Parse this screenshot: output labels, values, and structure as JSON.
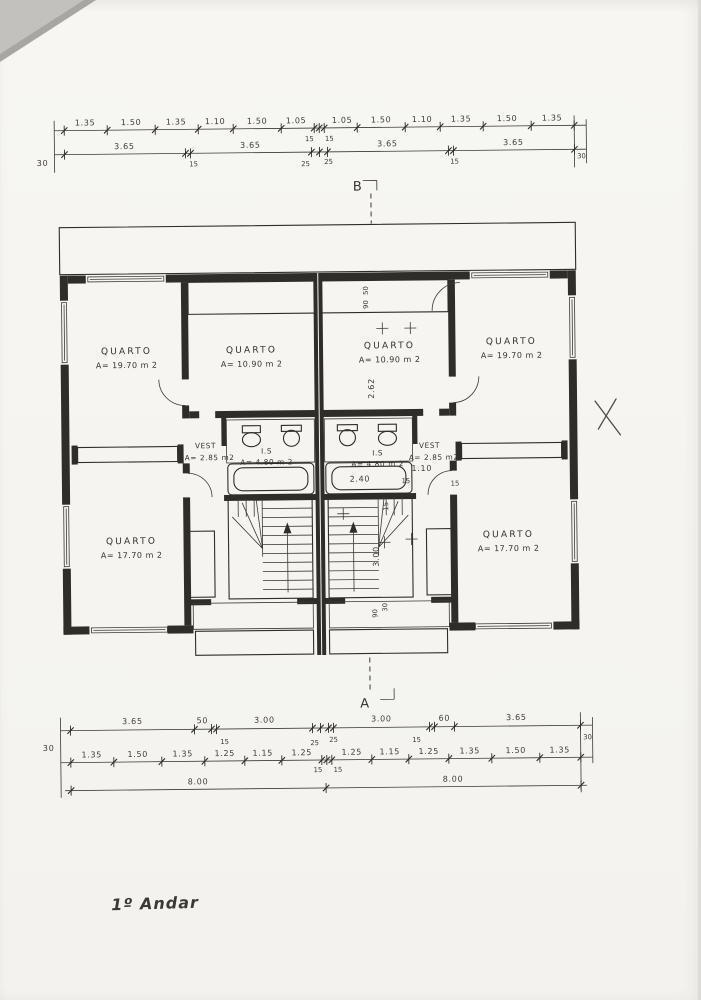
{
  "title": {
    "floor_label": "1º Andar"
  },
  "section_markers": {
    "top": "B",
    "bottom": "A"
  },
  "colors": {
    "ink": "#2e2d2a",
    "paper": "#f6f5f1"
  },
  "top_dims": {
    "end_left": "30",
    "end_right": "30",
    "row1": [
      "1.35",
      "1.50",
      "1.35",
      "1.10",
      "1.50",
      "1.05",
      "15",
      "15",
      "1.05",
      "1.50",
      "1.10",
      "1.35",
      "1.50",
      "1.35"
    ],
    "row2": [
      "3.65",
      "15",
      "3.65",
      "25",
      "25",
      "3.65",
      "15",
      "3.65"
    ]
  },
  "bottom_dims": {
    "end_left": "30",
    "end_right": "30",
    "row1": [
      "3.65",
      "50",
      "15",
      "3.00",
      "25",
      "25",
      "3.00",
      "15",
      "60",
      "3.65"
    ],
    "row2": [
      "1.35",
      "1.50",
      "1.35",
      "1.25",
      "1.15",
      "1.25",
      "15",
      "15",
      "1.25",
      "1.15",
      "1.25",
      "1.35",
      "1.50",
      "1.35"
    ],
    "row3": [
      "8.00",
      "8.00"
    ]
  },
  "rooms": [
    {
      "name": "QUARTO",
      "area": "A= 19.70 m 2"
    },
    {
      "name": "QUARTO",
      "area": "A= 10.90 m 2"
    },
    {
      "name": "QUARTO",
      "area": "A= 10.90 m 2"
    },
    {
      "name": "QUARTO",
      "area": "A= 19.70 m 2"
    },
    {
      "name": "QUARTO",
      "area": "A= 17.70 m 2"
    },
    {
      "name": "QUARTO",
      "area": "A= 17.70 m 2"
    }
  ],
  "vestibules": [
    {
      "name": "VEST",
      "area": "A= 2.85 m2"
    },
    {
      "name": "VEST",
      "area": "A= 2.85 m2"
    }
  ],
  "bathrooms": [
    {
      "name": "I.S",
      "area": "A= 4.80 m 2"
    },
    {
      "name": "I.S",
      "area": "A= 4.80 m 2"
    }
  ],
  "inner_dims": {
    "tub_width": "2.40",
    "hall_width": "1.10",
    "hall_tick_a": "15",
    "hall_tick_b": "15",
    "stair_flight": "3.00",
    "closet_depth": "2.62",
    "brick_a": "50",
    "brick_b": "90",
    "stair_tick": "15",
    "terrace_a": "90",
    "terrace_b": "30"
  }
}
